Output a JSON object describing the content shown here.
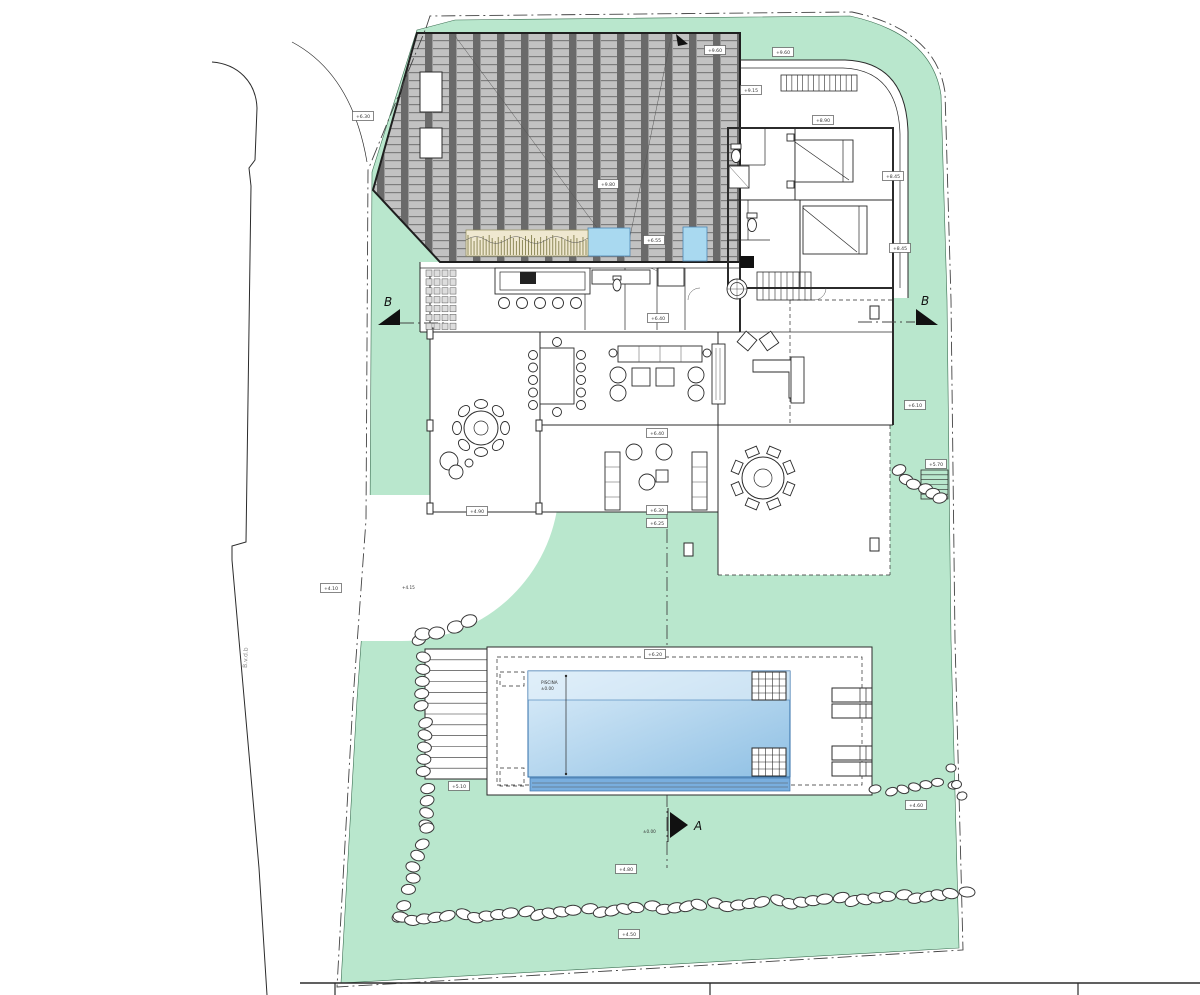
{
  "meta": {
    "drawing_type": "villa site plan with pool",
    "view": "top"
  },
  "colors": {
    "lawn": "#b9e7cd",
    "lawn_edge": "#3c6e52",
    "pool_light": "#dcedf9",
    "pool_dark": "#8fc0e4",
    "pool_deep": "#79aede",
    "water_feature": "#a9d9f0",
    "roof_tile": "#c2c2c2",
    "roof_joint": "#6a6a6a",
    "planter": "#efe8d0",
    "line": "#2b2b2b"
  },
  "markers": {
    "section_a": "A",
    "section_b_left": "B",
    "section_b_right": "B"
  },
  "road": {
    "label": "B.v.d.b"
  },
  "pool": {
    "label": "PISCINA",
    "sublabel": "±0.00"
  },
  "annotations": {
    "driveway_level": "+4.15",
    "section_a_level": "±0.00"
  },
  "level_labels": [
    {
      "x": 363,
      "y": 116,
      "text": "+6.30"
    },
    {
      "x": 715,
      "y": 50,
      "text": "+9.60"
    },
    {
      "x": 783,
      "y": 52,
      "text": "+9.60"
    },
    {
      "x": 751,
      "y": 90,
      "text": "+9.15"
    },
    {
      "x": 823,
      "y": 120,
      "text": "+8.90"
    },
    {
      "x": 893,
      "y": 176,
      "text": "+8.45"
    },
    {
      "x": 900,
      "y": 248,
      "text": "+8.45"
    },
    {
      "x": 608,
      "y": 184,
      "text": "+9.80"
    },
    {
      "x": 654,
      "y": 240,
      "text": "+6.55"
    },
    {
      "x": 658,
      "y": 318,
      "text": "+6.40"
    },
    {
      "x": 915,
      "y": 405,
      "text": "+6.10"
    },
    {
      "x": 936,
      "y": 464,
      "text": "+5.70"
    },
    {
      "x": 657,
      "y": 433,
      "text": "+6.40"
    },
    {
      "x": 657,
      "y": 510,
      "text": "+6.30"
    },
    {
      "x": 657,
      "y": 523,
      "text": "+6.25"
    },
    {
      "x": 477,
      "y": 511,
      "text": "+4.90"
    },
    {
      "x": 331,
      "y": 588,
      "text": "+4.10"
    },
    {
      "x": 655,
      "y": 654,
      "text": "+6.20"
    },
    {
      "x": 459,
      "y": 786,
      "text": "+5.10"
    },
    {
      "x": 916,
      "y": 805,
      "text": "+4.60"
    },
    {
      "x": 626,
      "y": 869,
      "text": "+4.80"
    },
    {
      "x": 629,
      "y": 934,
      "text": "+4.50"
    }
  ],
  "stone_walls": [
    {
      "x1": 421,
      "y1": 642,
      "x2": 427,
      "y2": 826,
      "n": 15,
      "rx": 7,
      "ry": 5
    },
    {
      "x1": 426,
      "y1": 830,
      "x2": 400,
      "y2": 916,
      "n": 8,
      "rx": 7,
      "ry": 5
    },
    {
      "x1": 424,
      "y1": 636,
      "x2": 468,
      "y2": 621,
      "n": 4,
      "rx": 8,
      "ry": 6
    },
    {
      "x1": 399,
      "y1": 919,
      "x2": 965,
      "y2": 894,
      "n": 46,
      "rx": 8,
      "ry": 5
    },
    {
      "x1": 899,
      "y1": 472,
      "x2": 940,
      "y2": 500,
      "n": 6,
      "rx": 7,
      "ry": 5
    },
    {
      "x1": 877,
      "y1": 791,
      "x2": 952,
      "y2": 783,
      "n": 7,
      "rx": 6,
      "ry": 4
    },
    {
      "x1": 950,
      "y1": 770,
      "x2": 963,
      "y2": 795,
      "n": 3,
      "rx": 5,
      "ry": 4
    }
  ],
  "stairs": [
    {
      "x": 781,
      "y": 75,
      "w": 76,
      "h": 16,
      "n": 14,
      "orient": "v"
    },
    {
      "x": 757,
      "y": 272,
      "w": 54,
      "h": 28,
      "n": 9,
      "orient": "v"
    },
    {
      "x": 921,
      "y": 470,
      "w": 27,
      "h": 29,
      "n": 6,
      "orient": "h"
    },
    {
      "x": 425,
      "y": 649,
      "w": 62,
      "h": 130,
      "n": 12,
      "orient": "h"
    },
    {
      "x": 752,
      "y": 672,
      "w": 34,
      "h": 28,
      "n": 5,
      "orient": "v"
    },
    {
      "x": 752,
      "y": 672,
      "w": 34,
      "h": 28,
      "n": 4,
      "orient": "h"
    },
    {
      "x": 752,
      "y": 748,
      "w": 34,
      "h": 28,
      "n": 5,
      "orient": "v"
    },
    {
      "x": 752,
      "y": 748,
      "w": 34,
      "h": 28,
      "n": 4,
      "orient": "h"
    }
  ],
  "loungers": {
    "w": 40,
    "h": 14,
    "items": [
      {
        "x": 832,
        "y": 688
      },
      {
        "x": 832,
        "y": 704
      },
      {
        "x": 832,
        "y": 746
      },
      {
        "x": 832,
        "y": 762
      }
    ]
  },
  "stools": {
    "cx0": 504,
    "cy": 303,
    "step": 18,
    "n": 5,
    "r": 5.5
  },
  "dining": {
    "left_x": 533,
    "right_x": 581,
    "y0": 355,
    "step": 12.5,
    "n": 5,
    "cap_top": [
      557,
      342
    ],
    "cap_bot": [
      557,
      412
    ],
    "r": 4.5
  },
  "round_tables": [
    {
      "cx": 481,
      "cy": 428,
      "r": 17,
      "ri": 7,
      "orbit": 24,
      "chair": "ellipse",
      "n": 8,
      "offset": 0
    },
    {
      "cx": 763,
      "cy": 478,
      "r": 21,
      "ri": 9,
      "orbit": 28,
      "chair": "rect",
      "n": 8,
      "offset": 22.5
    }
  ],
  "planter": {
    "x": 466,
    "y": 230,
    "w": 122,
    "h": 26,
    "n": 40
  },
  "storage": {
    "x": 425,
    "y": 269,
    "w": 32,
    "h": 62,
    "rows": 7,
    "cols": 4
  },
  "titleblock": {
    "y": 983,
    "x1": 300,
    "x2": 1200,
    "ticks": [
      335,
      710,
      1078
    ]
  }
}
